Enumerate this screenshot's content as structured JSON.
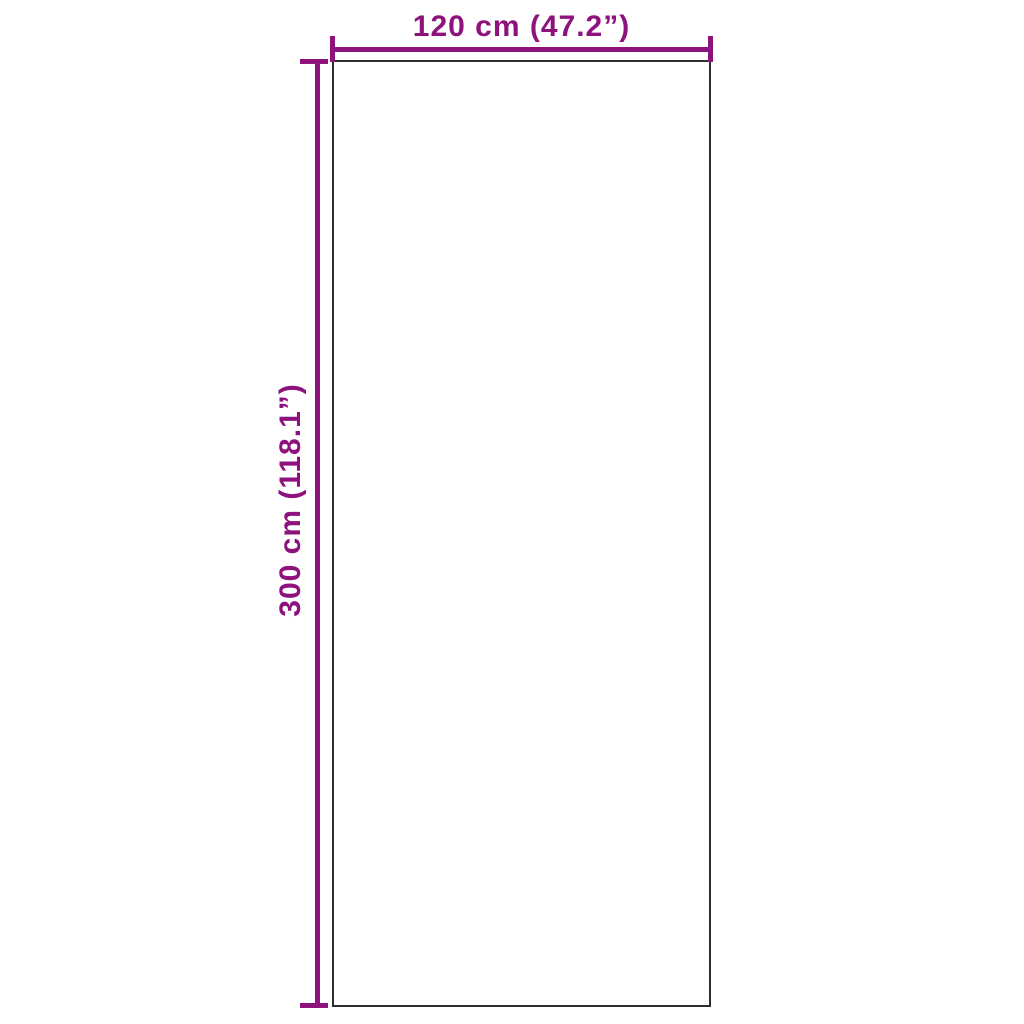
{
  "diagram": {
    "type": "product-dimension-drawing",
    "width_label": "120 cm (47.2”)",
    "height_label": "300 cm (118.1”)",
    "accent_color": "#8E127C",
    "outline_color": "#2E2E2E",
    "background_color": "#FFFFFF"
  }
}
